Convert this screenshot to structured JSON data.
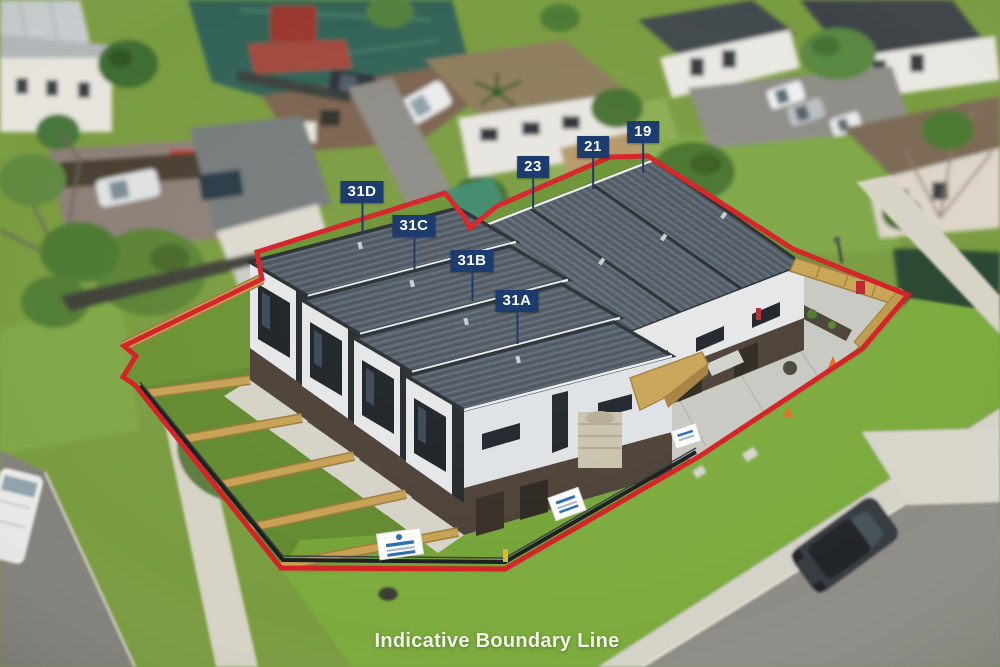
{
  "scene": {
    "caption": "Indicative Boundary Line",
    "colors": {
      "boundary_red": "#d42025",
      "label_background": "#1d3c6e",
      "label_text": "#ffffff"
    }
  },
  "unit_labels": [
    {
      "text": "31D"
    },
    {
      "text": "31C"
    },
    {
      "text": "31B"
    },
    {
      "text": "31A"
    },
    {
      "text": "23"
    },
    {
      "text": "21"
    },
    {
      "text": "19"
    }
  ]
}
